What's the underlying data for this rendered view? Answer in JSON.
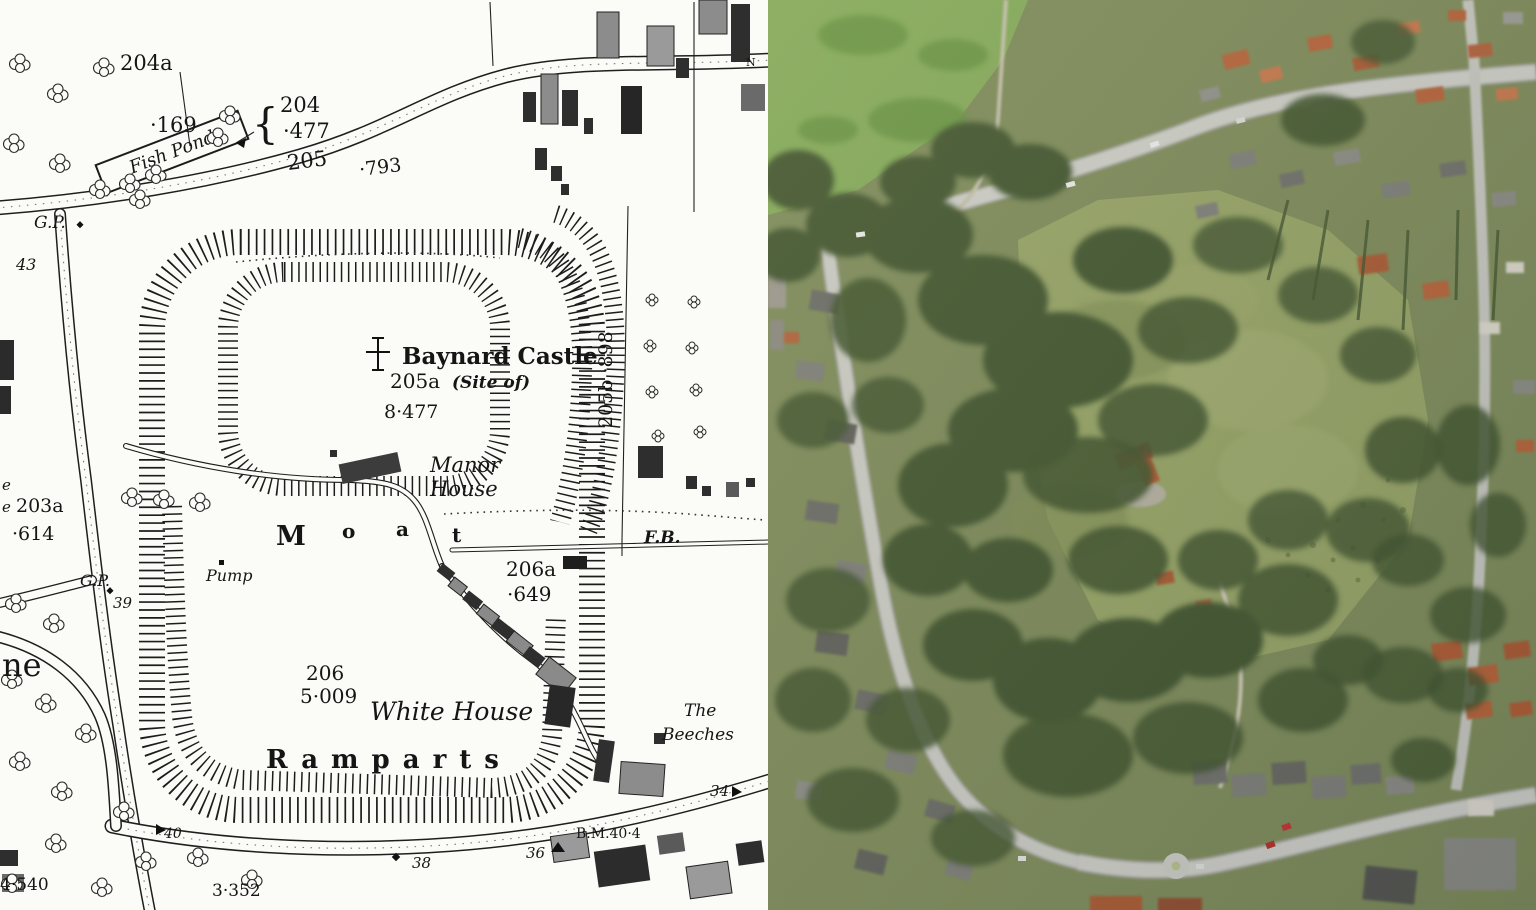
{
  "map": {
    "labels": {
      "p204a": "204a",
      "v169": "·169",
      "fish_pond": "Fish Pond",
      "brace_204": "{",
      "p204": "204",
      "v477": "·477",
      "r205": "205",
      "v793": "·793",
      "gp_top": "G.P.",
      "n43": "43",
      "p205b_v": "205b ·898",
      "baynard": "Baynard Castle",
      "p205a": "205a",
      "site_of": "(Site of)",
      "v8477": "8·477",
      "manor_1": "Manor",
      "manor_2": "House",
      "moat_m": "M",
      "moat_o": "o",
      "moat_a": "a",
      "moat_t": "t",
      "pump": "Pump",
      "gp_left": "G.P.",
      "n39": "39",
      "fb": "F.B.",
      "p206a": "206a",
      "v649": "·649",
      "frag_e1": "e",
      "frag_e2": "e",
      "p203a": "203a",
      "v614": "·614",
      "frag_ne": "ne",
      "p206": "206",
      "v5009": "5·009",
      "white_house": "White House",
      "ramparts": "Ramparts",
      "beeches_1": "The",
      "beeches_2": "Beeches",
      "n34": "34",
      "bm404": "B.M.40·4",
      "n36": "36",
      "n38": "38",
      "n40": "40",
      "v4540": "4·540",
      "v3352": "3·352",
      "north": "N"
    }
  },
  "colors": {
    "map_paper": "#fbfbf8",
    "map_ink": "#1c1c1c",
    "aerial_grass_park": "#83a857",
    "aerial_field": "#95a264",
    "aerial_tree": "#42552e",
    "aerial_road": "#cbcbc3",
    "aerial_roof_orange": "#b56238",
    "aerial_roof_gray": "#7d7d76",
    "aerial_manor_roof": "#a84a2c"
  }
}
